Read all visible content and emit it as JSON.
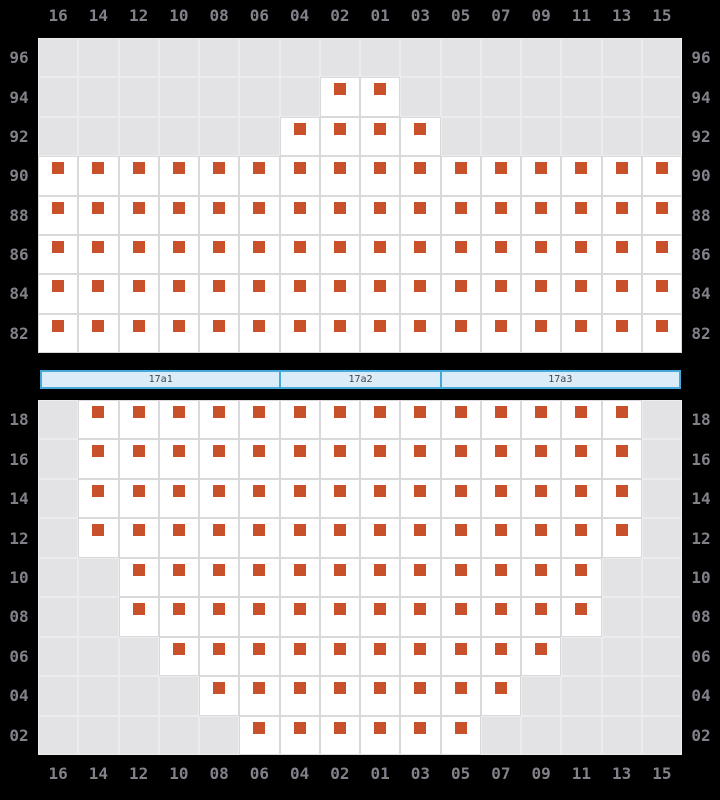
{
  "colors": {
    "background": "#000000",
    "cell_empty": "#e3e3e6",
    "cell_available": "#ffffff",
    "grid_line": "#d9d9dc",
    "grid_line_empty": "#ececee",
    "seat": "#c8512b",
    "axis_label": "#81818a",
    "bar_fill": "#d9ecf8",
    "bar_border": "#45a9da",
    "bar_text": "#454545"
  },
  "columns": [
    "16",
    "14",
    "12",
    "10",
    "08",
    "06",
    "04",
    "02",
    "01",
    "03",
    "05",
    "07",
    "09",
    "11",
    "13",
    "15"
  ],
  "top_section": {
    "row_labels": [
      "96",
      "94",
      "92",
      "90",
      "88",
      "86",
      "84",
      "82"
    ],
    "rows": [
      {
        "label": "96",
        "seat_cols": []
      },
      {
        "label": "94",
        "seat_cols": [
          "02",
          "01"
        ]
      },
      {
        "label": "92",
        "seat_cols": [
          "04",
          "02",
          "01",
          "03"
        ]
      },
      {
        "label": "90",
        "seat_cols": [
          "16",
          "14",
          "12",
          "10",
          "08",
          "06",
          "04",
          "02",
          "01",
          "03",
          "05",
          "07",
          "09",
          "11",
          "13",
          "15"
        ]
      },
      {
        "label": "88",
        "seat_cols": [
          "16",
          "14",
          "12",
          "10",
          "08",
          "06",
          "04",
          "02",
          "01",
          "03",
          "05",
          "07",
          "09",
          "11",
          "13",
          "15"
        ]
      },
      {
        "label": "86",
        "seat_cols": [
          "16",
          "14",
          "12",
          "10",
          "08",
          "06",
          "04",
          "02",
          "01",
          "03",
          "05",
          "07",
          "09",
          "11",
          "13",
          "15"
        ]
      },
      {
        "label": "84",
        "seat_cols": [
          "16",
          "14",
          "12",
          "10",
          "08",
          "06",
          "04",
          "02",
          "01",
          "03",
          "05",
          "07",
          "09",
          "11",
          "13",
          "15"
        ]
      },
      {
        "label": "82",
        "seat_cols": [
          "16",
          "14",
          "12",
          "10",
          "08",
          "06",
          "04",
          "02",
          "01",
          "03",
          "05",
          "07",
          "09",
          "11",
          "13",
          "15"
        ]
      }
    ]
  },
  "divider_bar": {
    "segments": [
      {
        "label": "17a1",
        "span": 6
      },
      {
        "label": "17a2",
        "span": 4
      },
      {
        "label": "17a3",
        "span": 6
      }
    ]
  },
  "bottom_section": {
    "row_labels": [
      "18",
      "16",
      "14",
      "12",
      "10",
      "08",
      "06",
      "04",
      "02"
    ],
    "rows": [
      {
        "label": "18",
        "seat_cols": [
          "14",
          "12",
          "10",
          "08",
          "06",
          "04",
          "02",
          "01",
          "03",
          "05",
          "07",
          "09",
          "11",
          "13"
        ]
      },
      {
        "label": "16",
        "seat_cols": [
          "14",
          "12",
          "10",
          "08",
          "06",
          "04",
          "02",
          "01",
          "03",
          "05",
          "07",
          "09",
          "11",
          "13"
        ]
      },
      {
        "label": "14",
        "seat_cols": [
          "14",
          "12",
          "10",
          "08",
          "06",
          "04",
          "02",
          "01",
          "03",
          "05",
          "07",
          "09",
          "11",
          "13"
        ]
      },
      {
        "label": "12",
        "seat_cols": [
          "14",
          "12",
          "10",
          "08",
          "06",
          "04",
          "02",
          "01",
          "03",
          "05",
          "07",
          "09",
          "11",
          "13"
        ]
      },
      {
        "label": "10",
        "seat_cols": [
          "12",
          "10",
          "08",
          "06",
          "04",
          "02",
          "01",
          "03",
          "05",
          "07",
          "09",
          "11"
        ]
      },
      {
        "label": "08",
        "seat_cols": [
          "12",
          "10",
          "08",
          "06",
          "04",
          "02",
          "01",
          "03",
          "05",
          "07",
          "09",
          "11"
        ]
      },
      {
        "label": "06",
        "seat_cols": [
          "10",
          "08",
          "06",
          "04",
          "02",
          "01",
          "03",
          "05",
          "07",
          "09"
        ]
      },
      {
        "label": "04",
        "seat_cols": [
          "08",
          "06",
          "04",
          "02",
          "01",
          "03",
          "05",
          "07"
        ]
      },
      {
        "label": "02",
        "seat_cols": [
          "06",
          "04",
          "02",
          "01",
          "03",
          "05"
        ]
      }
    ]
  }
}
